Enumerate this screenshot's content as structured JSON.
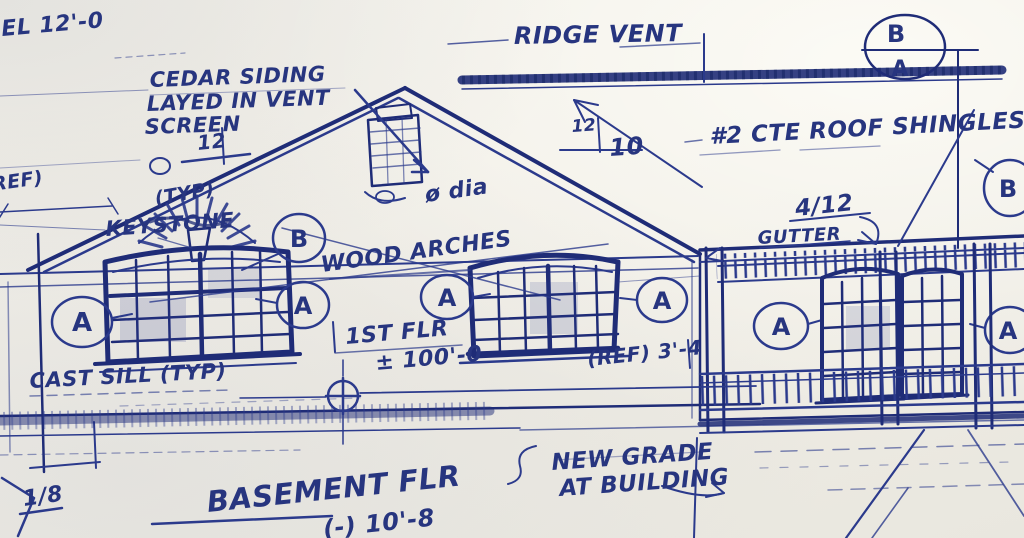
{
  "paper": {
    "bg": "#f0ede5",
    "ink": "#2b3a8c",
    "ink_dark": "#1f2c77"
  },
  "notes": {
    "corner_elevation": "EL 12'-0",
    "ridge_vent": "RIDGE VENT",
    "cedar_line1": "CEDAR SIDING",
    "cedar_line2": "LAYED IN VENT",
    "cedar_line3": "SCREEN",
    "pitch_left_rise": "12",
    "pitch_mid_rise": "12",
    "pitch_mid_run": "10",
    "roof_shingles": "#2 CTE ROOF SHINGLES",
    "ref_note": "(REF)",
    "typ_note": "(TYP)",
    "keystone": "KEYSTONE",
    "wood_arches": "WOOD ARCHES",
    "chimney_dia": "ø dia",
    "gutter": "GUTTER",
    "slope_right": "4/12",
    "first_floor_label": "1ST FLR",
    "first_floor_elev": "± 100'-0",
    "sill_note": "CAST SILL (TYP)",
    "ref_dim": "(REF) 3'-4",
    "new_grade_line1": "NEW GRADE",
    "new_grade_line2": "AT BUILDING",
    "basement_label": "BASEMENT FLR",
    "basement_elev": "(-) 10'-8",
    "scale_note": "1/8"
  },
  "markers": {
    "detail_circle_top": "B",
    "detail_circle_bottom": "A",
    "window_tag": "A",
    "arch_tag": "B",
    "edge_tag": "B"
  }
}
